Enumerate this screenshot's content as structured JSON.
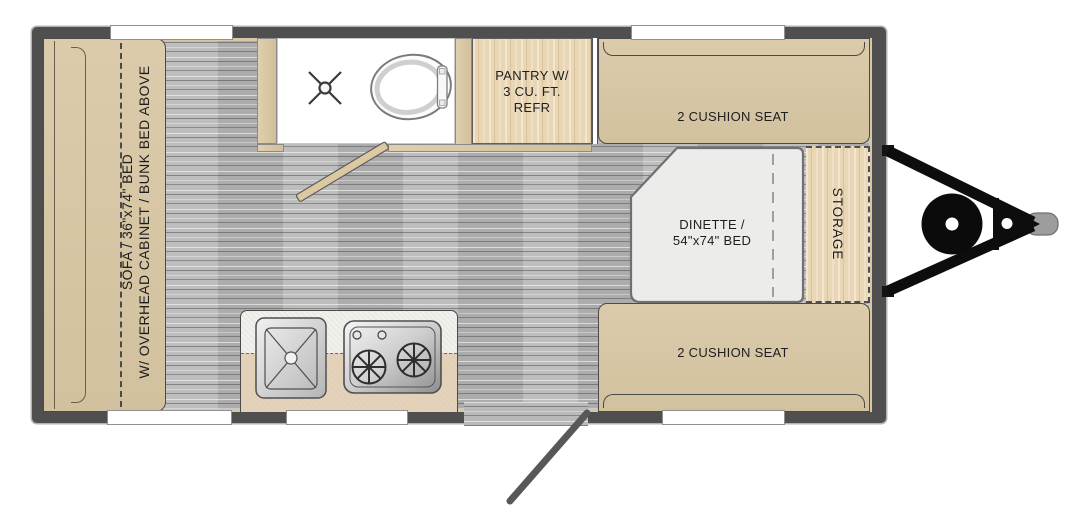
{
  "title": "Travel trailer floor plan",
  "floorplan": {
    "sofa": {
      "line1": "SOFA / 36\"x74\" BED",
      "line2": "W/ OVERHEAD CABINET / BUNK BED ABOVE"
    },
    "pantry": {
      "line1": "PANTRY W/",
      "line2": "3 CU. FT.",
      "line3": "REFR"
    },
    "seat_front": {
      "label": "2 CUSHION SEAT"
    },
    "seat_rear": {
      "label": "2 CUSHION SEAT"
    },
    "dinette": {
      "line1": "DINETTE /",
      "line2": "54\"x74\" BED"
    },
    "storage": {
      "label": "STORAGE"
    },
    "fixtures": [
      "shower-drain",
      "toilet",
      "bathroom-door",
      "kitchen-sink",
      "two-burner-stove",
      "entry-door",
      "a-frame-hitch",
      "tongue-jack-wheel",
      "hitch-coupler",
      "windows"
    ],
    "colors": {
      "wall": "#4f4f4f",
      "cushion": "#d6c5a4",
      "wood": "#e9d6b4",
      "floor": "#b9b9b9",
      "bath_floor": "#ffffff",
      "dinette_top": "#ececea",
      "counter": "#f2f1ed",
      "hitch": "#0d0d0d",
      "coupler": "#9d9d9d"
    }
  }
}
